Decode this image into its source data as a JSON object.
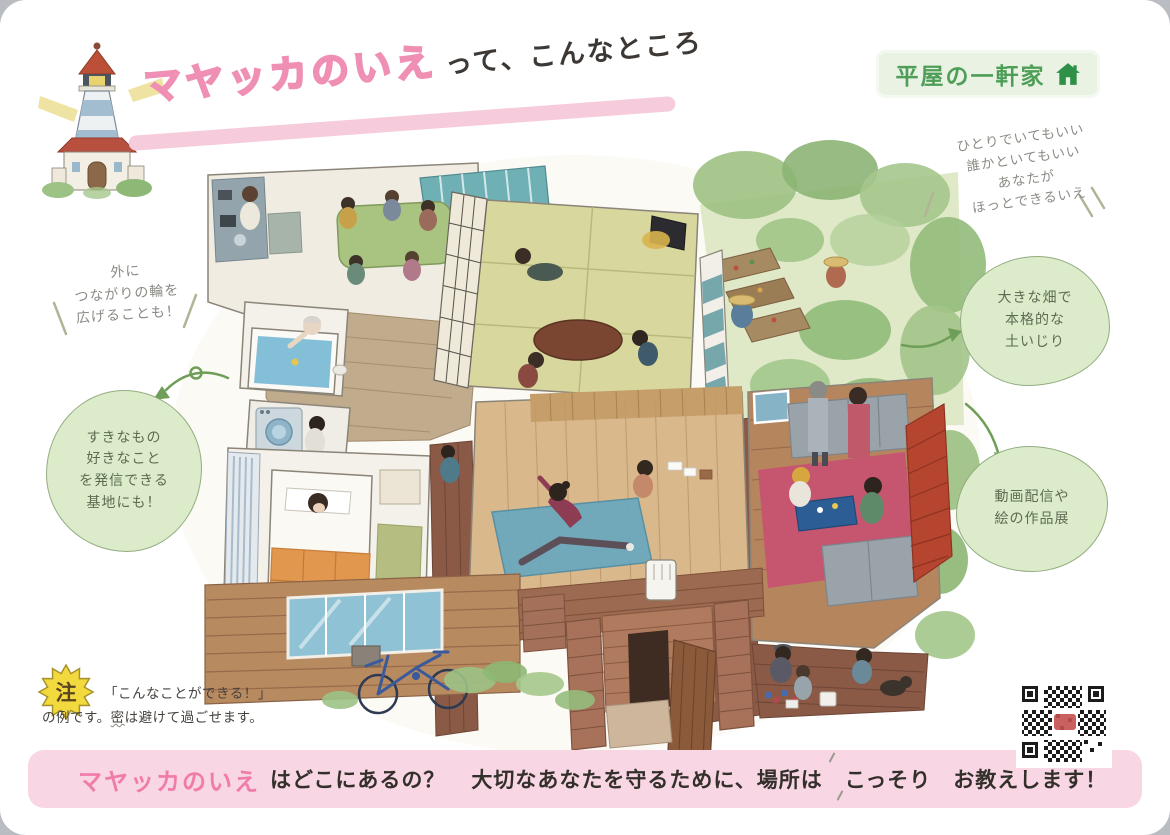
{
  "title": {
    "main": "マヤッカのいえ",
    "suffix": "って、こんなところ"
  },
  "badge": {
    "label": "平屋の一軒家",
    "icon": "house-icon"
  },
  "note_top_right": {
    "line1": "ひとりでいてもいい",
    "line2": "誰かといてもいい",
    "line3": "あなたが",
    "line4": "ほっとできるいえ"
  },
  "bubble_garden": {
    "line1": "大きな畑で",
    "line2": "本格的な",
    "line3": "土いじり"
  },
  "bubble_media": {
    "line1": "動画配信や",
    "line2": "絵の作品展"
  },
  "note_left": {
    "line1": "外に",
    "line2": "つながりの輪を",
    "line3": "広げることも！"
  },
  "bubble_base": {
    "line1": "すきなもの",
    "line2": "好きなこと",
    "line3": "を発信できる",
    "line4": "基地にも！"
  },
  "footnote": {
    "badge": "注",
    "line1": "「こんなことができる！」",
    "line2_pre": "の例です。",
    "line2_u": "密",
    "line2_post": "は避けて過ごせます。"
  },
  "footer": {
    "name": "マヤッカのいえ",
    "q": "はどこにあるの？",
    "mid": "大切なあなたを守るために、場所は",
    "emph": "こっそり",
    "end": "お教えします！"
  },
  "icons": {
    "top_left": "lighthouse-illustration",
    "top_right_badge": "house-icon",
    "note_badge": "note-starburst",
    "bottom_right": "qr-code"
  },
  "colors": {
    "accent_pink": "#f2a3c0",
    "deep_pink": "#ee7aa6",
    "bar_pink": "#f8d6e3",
    "bubble_green": "#dcecca",
    "bubble_border": "#93ac80",
    "badge_bg": "#e9f2e3",
    "badge_text": "#4e9e58",
    "note_gray": "#8b8b85",
    "ink": "#38342f"
  }
}
